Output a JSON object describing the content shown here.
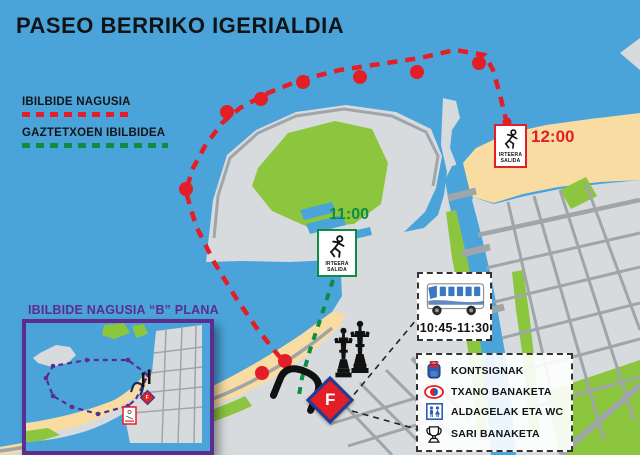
{
  "title": "PASEO BERRIKO IGERIALDIA",
  "legend": {
    "main_route_label": "IBILBIDE NAGUSIA",
    "youth_route_label": "GAZTETXOEN IBILBIDEA"
  },
  "markers": {
    "start_main": {
      "time": "12:00",
      "line1": "IRTEERA",
      "line2": "SALIDA"
    },
    "start_youth": {
      "time": "11:00",
      "line1": "IRTEERA",
      "line2": "SALIDA"
    },
    "finish_letter": "F"
  },
  "bus": {
    "schedule": "10:45-11:30"
  },
  "services": {
    "items": [
      {
        "icon": "backpack-icon",
        "label": "KONTSIGNAK"
      },
      {
        "icon": "swim-cap-icon",
        "label": "TXANO BANAKETA"
      },
      {
        "icon": "changing-room-icon",
        "label": "ALDAGELAK ETA WC"
      },
      {
        "icon": "trophy-icon",
        "label": "SARI BANAKETA"
      }
    ]
  },
  "inset": {
    "title": "IBILBIDE NAGUSIA “B” PLANA"
  },
  "colors": {
    "water": "#4BA4D9",
    "land": "#D8DBDD",
    "sand": "#F8DCA2",
    "park": "#8CC63E",
    "road": "#9FA5A8",
    "route_main": "#E31E26",
    "route_youth": "#0E8C44",
    "inset_purple": "#5B2D8E",
    "navy": "#1C3F94"
  }
}
